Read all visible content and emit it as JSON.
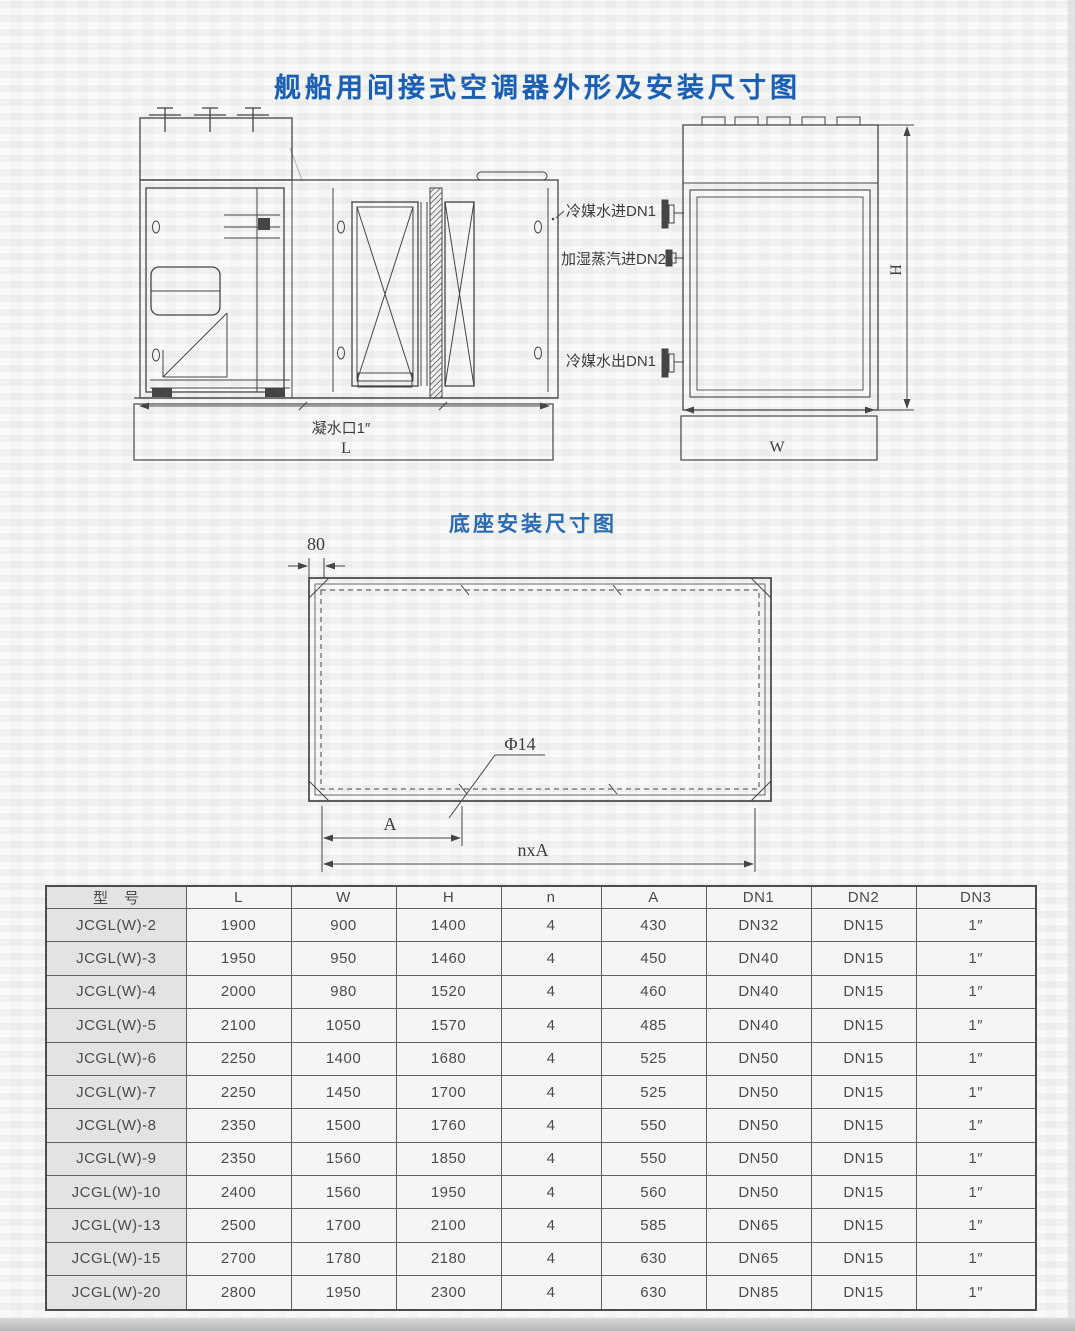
{
  "page": {
    "main_title": "舰船用间接式空调器外形及安装尺寸图",
    "base_diagram_title": "底座安装尺寸图"
  },
  "front_view": {
    "condensate_label": "凝水口1″",
    "length_dim": "L"
  },
  "side_view": {
    "chilled_water_in_label": "冷媒水进DN1",
    "steam_in_label": "加湿蒸汽进DN2",
    "chilled_water_out_label": "冷媒水出DN1",
    "height_dim": "H",
    "width_dim": "W"
  },
  "base_diagram": {
    "edge_offset_dim": "80",
    "hole_diameter_label": "Φ14",
    "pitch_dim": "A",
    "total_pitch_dim": "nxA"
  },
  "table": {
    "headers": [
      "型　号",
      "L",
      "W",
      "H",
      "n",
      "A",
      "DN1",
      "DN2",
      "DN3"
    ],
    "rows": [
      [
        "JCGL(W)-2",
        "1900",
        "900",
        "1400",
        "4",
        "430",
        "DN32",
        "DN15",
        "1″"
      ],
      [
        "JCGL(W)-3",
        "1950",
        "950",
        "1460",
        "4",
        "450",
        "DN40",
        "DN15",
        "1″"
      ],
      [
        "JCGL(W)-4",
        "2000",
        "980",
        "1520",
        "4",
        "460",
        "DN40",
        "DN15",
        "1″"
      ],
      [
        "JCGL(W)-5",
        "2100",
        "1050",
        "1570",
        "4",
        "485",
        "DN40",
        "DN15",
        "1″"
      ],
      [
        "JCGL(W)-6",
        "2250",
        "1400",
        "1680",
        "4",
        "525",
        "DN50",
        "DN15",
        "1″"
      ],
      [
        "JCGL(W)-7",
        "2250",
        "1450",
        "1700",
        "4",
        "525",
        "DN50",
        "DN15",
        "1″"
      ],
      [
        "JCGL(W)-8",
        "2350",
        "1500",
        "1760",
        "4",
        "550",
        "DN50",
        "DN15",
        "1″"
      ],
      [
        "JCGL(W)-9",
        "2350",
        "1560",
        "1850",
        "4",
        "550",
        "DN50",
        "DN15",
        "1″"
      ],
      [
        "JCGL(W)-10",
        "2400",
        "1560",
        "1950",
        "4",
        "560",
        "DN50",
        "DN15",
        "1″"
      ],
      [
        "JCGL(W)-13",
        "2500",
        "1700",
        "2100",
        "4",
        "585",
        "DN65",
        "DN15",
        "1″"
      ],
      [
        "JCGL(W)-15",
        "2700",
        "1780",
        "2180",
        "4",
        "630",
        "DN65",
        "DN15",
        "1″"
      ],
      [
        "JCGL(W)-20",
        "2800",
        "1950",
        "2300",
        "4",
        "630",
        "DN85",
        "DN15",
        "1″"
      ]
    ]
  },
  "colors": {
    "title_blue": "#1c5fb0",
    "subtitle_blue": "#2a6cb3",
    "line_gray": "#454545",
    "table_text": "#4b4b4b"
  }
}
